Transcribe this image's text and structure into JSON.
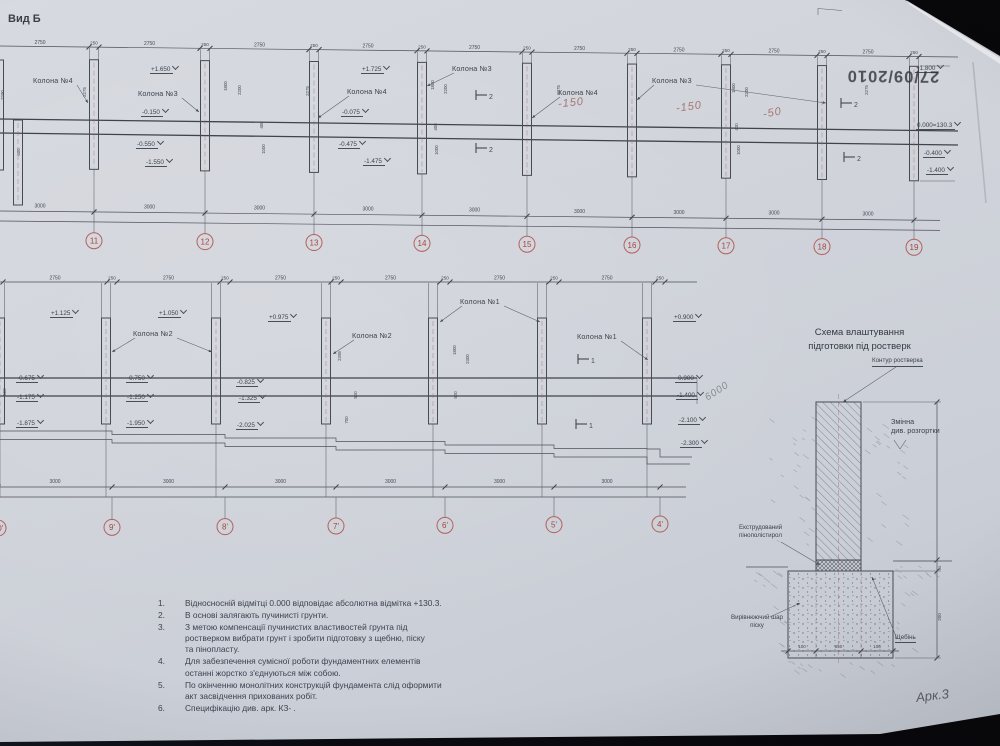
{
  "photo": {
    "date_stamp": "27/09/2010",
    "sheet_note": "Арк.3"
  },
  "colors": {
    "axis_red": "#a8443e",
    "ink": "#3e434c",
    "paper": "#d1d4db"
  },
  "top_view": {
    "title": "Вид Б",
    "bay_dim": "2750",
    "pier_dim": "250",
    "spacing_dim": "3000",
    "axes": [
      {
        "label": "11",
        "x": 94
      },
      {
        "label": "12",
        "x": 205
      },
      {
        "label": "13",
        "x": 314
      },
      {
        "label": "14",
        "x": 422
      },
      {
        "label": "15",
        "x": 527
      },
      {
        "label": "16",
        "x": 632
      },
      {
        "label": "17",
        "x": 726
      },
      {
        "label": "18",
        "x": 822
      },
      {
        "label": "19",
        "x": 914
      }
    ],
    "column_labels": [
      {
        "text": "Колона №4",
        "x": 33,
        "y": 76,
        "tx": 88,
        "ty": 103
      },
      {
        "text": "Колона №3",
        "x": 138,
        "y": 89,
        "tx": 199,
        "ty": 112
      },
      {
        "text": "Колона №4",
        "x": 347,
        "y": 87,
        "tx": 318,
        "ty": 118
      },
      {
        "text": "Колона №3",
        "x": 452,
        "y": 64,
        "tx": 427,
        "ty": 86
      },
      {
        "text": "Колона №4",
        "x": 558,
        "y": 88,
        "tx": 532,
        "ty": 118
      },
      {
        "text": "Колона №3",
        "x": 652,
        "y": 76,
        "tx": 637,
        "ty": 100,
        "tx2": 826,
        "ty2": 103
      }
    ],
    "elevations": [
      {
        "t": "+1.650",
        "x": 150,
        "y": 58
      },
      {
        "t": "-0.150",
        "x": 141,
        "y": 101
      },
      {
        "t": "-0.550",
        "x": 136,
        "y": 133
      },
      {
        "t": "-1.550",
        "x": 145,
        "y": 151
      },
      {
        "t": "+1.725",
        "x": 361,
        "y": 58
      },
      {
        "t": "-0.075",
        "x": 341,
        "y": 101
      },
      {
        "t": "-0.475",
        "x": 338,
        "y": 133
      },
      {
        "t": "-1.475",
        "x": 363,
        "y": 150
      },
      {
        "t": "+1.800",
        "x": 915,
        "y": 57
      },
      {
        "t": "0.000=130.3",
        "x": 916,
        "y": 114
      },
      {
        "t": "-0.400",
        "x": 923,
        "y": 142
      },
      {
        "t": "-1.400",
        "x": 926,
        "y": 159
      }
    ],
    "handwritten": [
      {
        "t": "-150",
        "x": 558,
        "y": 97,
        "r": -6
      },
      {
        "t": "-150",
        "x": 676,
        "y": 101,
        "r": -8
      },
      {
        "t": "-50",
        "x": 763,
        "y": 107,
        "r": -10
      }
    ],
    "sections": [
      {
        "label": "2",
        "x": 476,
        "y": 95
      },
      {
        "label": "2",
        "x": 476,
        "y": 148
      },
      {
        "label": "2",
        "x": 841,
        "y": 103
      },
      {
        "label": "2",
        "x": 844,
        "y": 157
      }
    ],
    "small_dims": [
      {
        "t": "2290",
        "x": 4,
        "y": 95
      },
      {
        "t": "2275",
        "x": 86,
        "y": 92
      },
      {
        "t": "600",
        "x": 20,
        "y": 152
      },
      {
        "t": "1800",
        "x": 227,
        "y": 86
      },
      {
        "t": "2200",
        "x": 241,
        "y": 90
      },
      {
        "t": "400",
        "x": 263,
        "y": 125
      },
      {
        "t": "1000",
        "x": 265,
        "y": 149
      },
      {
        "t": "2275",
        "x": 309,
        "y": 91
      },
      {
        "t": "1800",
        "x": 434,
        "y": 85
      },
      {
        "t": "2200",
        "x": 447,
        "y": 89
      },
      {
        "t": "400",
        "x": 437,
        "y": 127
      },
      {
        "t": "1000",
        "x": 438,
        "y": 150
      },
      {
        "t": "2275",
        "x": 560,
        "y": 90
      },
      {
        "t": "1800",
        "x": 735,
        "y": 88
      },
      {
        "t": "2200",
        "x": 748,
        "y": 92
      },
      {
        "t": "400",
        "x": 738,
        "y": 127
      },
      {
        "t": "1000",
        "x": 740,
        "y": 150
      },
      {
        "t": "2275",
        "x": 868,
        "y": 90
      }
    ]
  },
  "bottom_view": {
    "bay_dim": "2750",
    "pier_dim": "250",
    "spacing_dim": "3000",
    "axes": [
      {
        "label": "10'",
        "x": -2
      },
      {
        "label": "9'",
        "x": 112
      },
      {
        "label": "8'",
        "x": 225
      },
      {
        "label": "7'",
        "x": 336
      },
      {
        "label": "6'",
        "x": 445
      },
      {
        "label": "5'",
        "x": 554
      },
      {
        "label": "4'",
        "x": 660
      }
    ],
    "column_labels": [
      {
        "text": "Колона №2",
        "x": 133,
        "y": 329,
        "tx": 112,
        "ty": 352,
        "tx2": 212,
        "ty2": 352
      },
      {
        "text": "Колона №2",
        "x": 352,
        "y": 331,
        "tx": 333,
        "ty": 354
      },
      {
        "text": "Колона №1",
        "x": 460,
        "y": 297,
        "tx": 440,
        "ty": 322,
        "tx2": 540,
        "ty2": 322
      },
      {
        "text": "Колона №1",
        "x": 577,
        "y": 332,
        "tx": 648,
        "ty": 360
      }
    ],
    "elevations": [
      {
        "t": "+1.125",
        "x": 50,
        "y": 302
      },
      {
        "t": "+1.050",
        "x": 158,
        "y": 302
      },
      {
        "t": "+0.975",
        "x": 268,
        "y": 306
      },
      {
        "t": "+0.900",
        "x": 673,
        "y": 306
      },
      {
        "t": "-0.675",
        "x": 16,
        "y": 367
      },
      {
        "t": "-0.750",
        "x": 126,
        "y": 367
      },
      {
        "t": "-0.825",
        "x": 236,
        "y": 371
      },
      {
        "t": "-0.900",
        "x": 675,
        "y": 367
      },
      {
        "t": "-1.175",
        "x": 16,
        "y": 386
      },
      {
        "t": "-1.250",
        "x": 126,
        "y": 386
      },
      {
        "t": "-1.325",
        "x": 238,
        "y": 387
      },
      {
        "t": "-1.400",
        "x": 676,
        "y": 384
      },
      {
        "t": "-1.875",
        "x": 16,
        "y": 412
      },
      {
        "t": "-1.950",
        "x": 126,
        "y": 412
      },
      {
        "t": "-2.025",
        "x": 236,
        "y": 414
      },
      {
        "t": "-2.100",
        "x": 678,
        "y": 409
      },
      {
        "t": "-2.300",
        "x": 680,
        "y": 432
      }
    ],
    "handwritten": [
      {
        "t": "6000",
        "x": 704,
        "y": 386,
        "r": -33,
        "pencil": true
      }
    ],
    "sections": [
      {
        "label": "1",
        "x": 578,
        "y": 359
      },
      {
        "label": "1",
        "x": 576,
        "y": 424
      }
    ],
    "small_dims": [
      {
        "t": "2395",
        "x": 341,
        "y": 356
      },
      {
        "t": "1800",
        "x": 456,
        "y": 350
      },
      {
        "t": "2300",
        "x": 469,
        "y": 359
      },
      {
        "t": "500",
        "x": 357,
        "y": 395
      },
      {
        "t": "500",
        "x": 457,
        "y": 395
      },
      {
        "t": "560",
        "x": 6,
        "y": 392
      },
      {
        "t": "700",
        "x": 348,
        "y": 420
      }
    ]
  },
  "schema": {
    "title_line1": "Схема влаштування",
    "title_line2": "підготовки під ростверк",
    "labels": {
      "kontur": "Контур ростверка",
      "zminna": "Змінна\nдив. розгортки",
      "polystyrene": "Екструдований\nпінополістирол",
      "sand": "Вирівнюючий шар\nпіску",
      "gravel": "Щебінь"
    },
    "dims": {
      "left": "100",
      "middle": "650",
      "right": "100",
      "height": "200",
      "thin": "50"
    }
  },
  "notes": {
    "items": [
      {
        "num": "1.",
        "text": "Відносноснiй відмітці 0.000 відповідає абсолютна відмітка +130.3."
      },
      {
        "num": "2.",
        "text": "В основі залягають пучинисті грунти."
      },
      {
        "num": "3.",
        "text": "З метою компенсації пучинистих властивостей грунта під\nростверком вибрати грунт і зробити підготовку з щебню, піску\nта пінопласту."
      },
      {
        "num": "4.",
        "text": "Для забезпечення сумісної роботи фундаментних елементів\nостанні жорстко з'єднуються між собою."
      },
      {
        "num": "5.",
        "text": "По окінченню монолітних конструкцій фундамента слід оформити\nакт засвідчення прихованих робіт."
      },
      {
        "num": "6.",
        "text": "Специфікацію див. арк. КЗ-    ."
      }
    ]
  }
}
